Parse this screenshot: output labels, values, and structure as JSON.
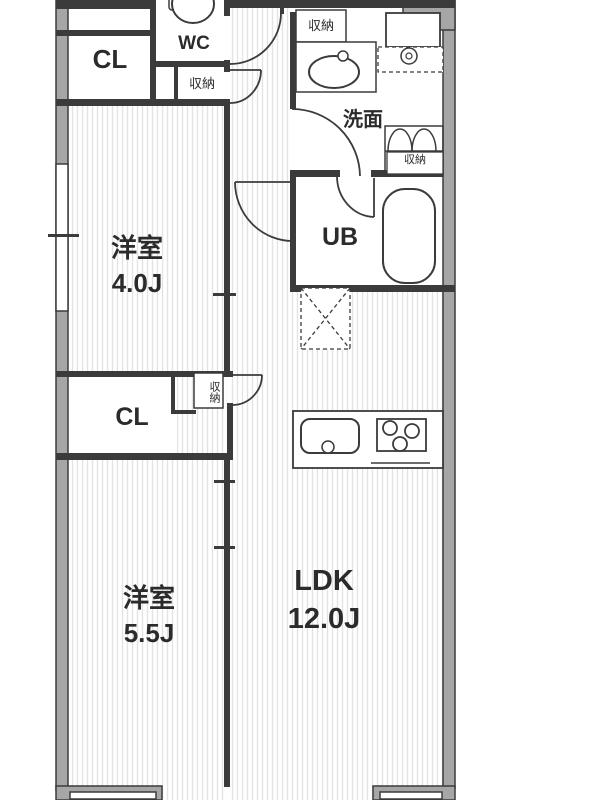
{
  "floorplan": {
    "rooms": {
      "closet_top": "CL",
      "wc": "WC",
      "storage_wc": "収納",
      "storage_washroom": "収納",
      "washroom": "洗面",
      "storage_bath": "収納",
      "unit_bath": "UB",
      "bedroom1_name": "洋室",
      "bedroom1_size": "4.0J",
      "closet_mid": "CL",
      "storage_hall": "収納",
      "bedroom2_name": "洋室",
      "bedroom2_size": "5.5J",
      "ldk_name": "LDK",
      "ldk_size": "12.0J"
    },
    "colors": {
      "wall_line": "#3b3b3b",
      "wall_fill": "#a6a6a6",
      "floor_hatch": "#e3e3e3",
      "text": "#2b2b2b",
      "background": "#ffffff"
    }
  }
}
